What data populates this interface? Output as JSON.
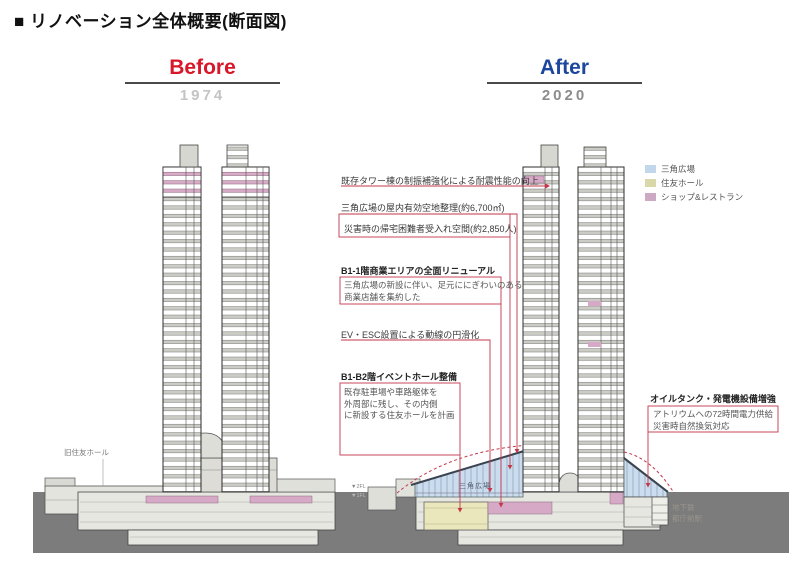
{
  "title": "■ リノベーション全体概要(断面図)",
  "before": {
    "label": "Before",
    "year": "1974"
  },
  "after": {
    "label": "After",
    "year": "2020"
  },
  "legend": {
    "items": [
      {
        "label": "三角広場",
        "color": "#c3d7ec"
      },
      {
        "label": "住友ホール",
        "color": "#d8d8aa"
      },
      {
        "label": "ショップ&レストラン",
        "color": "#cda9c4"
      }
    ]
  },
  "annotations": {
    "seismic": {
      "text": "既存タワー棟の制振補強化による耐震性能の向上"
    },
    "plaza_space": {
      "text": "三角広場の屋内有効空地整理(約6,700㎡)"
    },
    "disaster": {
      "text": "災害時の帰宅困難者受入れ空間(約2,850人)"
    },
    "commercial": {
      "title": "B1-1階商業エリアの全面リニューアル",
      "desc": [
        "三角広場の新設に伴い、足元ににぎわいのある",
        "商業店舗を集約した"
      ]
    },
    "circulation": {
      "text": "EV・ESC設置による動線の円滑化"
    },
    "event_hall": {
      "title": "B1-B2階イベントホール整備",
      "desc": [
        "既存駐車場や車路躯体を",
        "外周部に残し、その内側",
        "に新設する住友ホールを計画"
      ]
    },
    "power": {
      "title": "オイルタンク・発電機設備増強",
      "desc": [
        "アトリウムへの72時間電力供給",
        "災害時自然換気対応"
      ]
    }
  },
  "drawing_labels": {
    "old_hall": "旧住友ホール",
    "plaza": "三角広場",
    "subway_line1": "地下鉄",
    "subway_line2": "都庁前駅",
    "level_2": "▼2FL",
    "level_1": "▼1FL"
  },
  "colors": {
    "annotation_red": "#c4374b",
    "before_red": "#d7182a",
    "after_blue": "#1b479e",
    "plaza_blue": "#cbdcee",
    "hall_yellow": "#ebe7bc",
    "shop_pink": "#d6a9c6",
    "ground_gray": "#7c7c7c"
  }
}
